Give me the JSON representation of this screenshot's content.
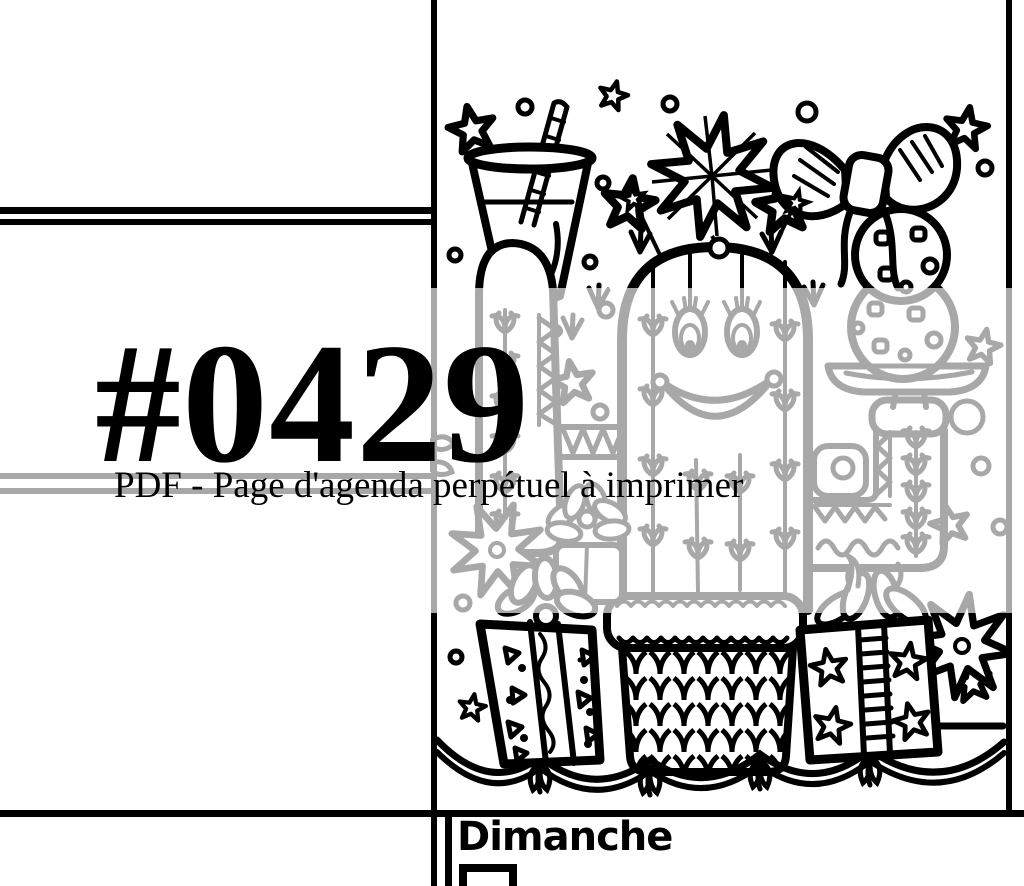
{
  "page": {
    "watermark": {
      "title": "#0429",
      "subtitle": "PDF - Page d'agenda perpétuel à imprimer"
    },
    "day_section": {
      "label": "Dimanche"
    },
    "colors": {
      "ink": "#000000",
      "paper": "#ffffff",
      "muted_gray": "#aaaaaa",
      "overlay": "rgba(255,255,255,0.66)"
    },
    "illustration": {
      "name": "christmas-cactus-coloring-illustration",
      "elements": [
        "drink-glass-with-straw",
        "striped-straw",
        "five-point-stars",
        "tree-topper-star",
        "gift-bow",
        "chocolate-chip-cookies",
        "cookie-plate",
        "smiling-cactus",
        "cactus-left-arm",
        "cactus-right-arm",
        "knitted-basket",
        "gift-box-triangles",
        "gift-box-stars",
        "poinsettia-flowers",
        "scalloped-garland",
        "flower-gift-sketch"
      ]
    }
  }
}
